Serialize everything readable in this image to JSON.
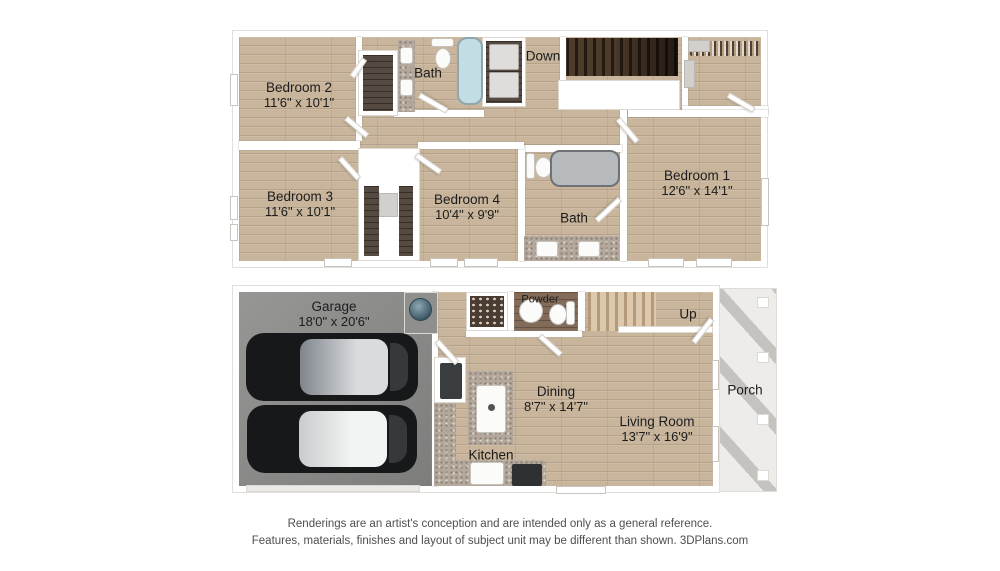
{
  "upper_floor": {
    "bedroom2": {
      "name": "Bedroom 2",
      "dims": "11'6\" x 10'1\""
    },
    "bedroom3": {
      "name": "Bedroom 3",
      "dims": "11'6\" x 10'1\""
    },
    "bedroom4": {
      "name": "Bedroom 4",
      "dims": "10'4\" x 9'9\""
    },
    "bedroom1": {
      "name": "Bedroom 1",
      "dims": "12'6\" x 14'1\""
    },
    "bath_top_label": "Bath",
    "bath_main_label": "Bath",
    "stairs_label": "Down"
  },
  "lower_floor": {
    "garage": {
      "name": "Garage",
      "dims": "18'0\" x 20'6\""
    },
    "powder_label": "Powder",
    "stairs_label": "Up",
    "dining": {
      "name": "Dining",
      "dims": "8'7\" x 14'7\""
    },
    "living_room": {
      "name": "Living Room",
      "dims": "13'7\" x 16'9\""
    },
    "kitchen_label": "Kitchen",
    "porch_label": "Porch"
  },
  "footer": {
    "line1": "Renderings are an artist's conception and are intended only as a general reference.",
    "line2": "Features, materials, finishes and layout of subject unit may be different than shown. 3DPlans.com"
  },
  "colors": {
    "wood_floor": "#c8b59c",
    "dark_wood_closet": "#4a3f36",
    "garage_floor": "#8e8f8d",
    "wall": "#ffffff",
    "tub_blue": "#c2dde4",
    "tub_gray": "#b7babc",
    "granite_counter": "#b3a89b",
    "stairs_dark": "#39291c",
    "porch": "#edecea",
    "car_body": "#17181a",
    "water_heater": "#3c5866",
    "label_text": "#1c1c1c",
    "footer_text": "#4e4e4e"
  }
}
